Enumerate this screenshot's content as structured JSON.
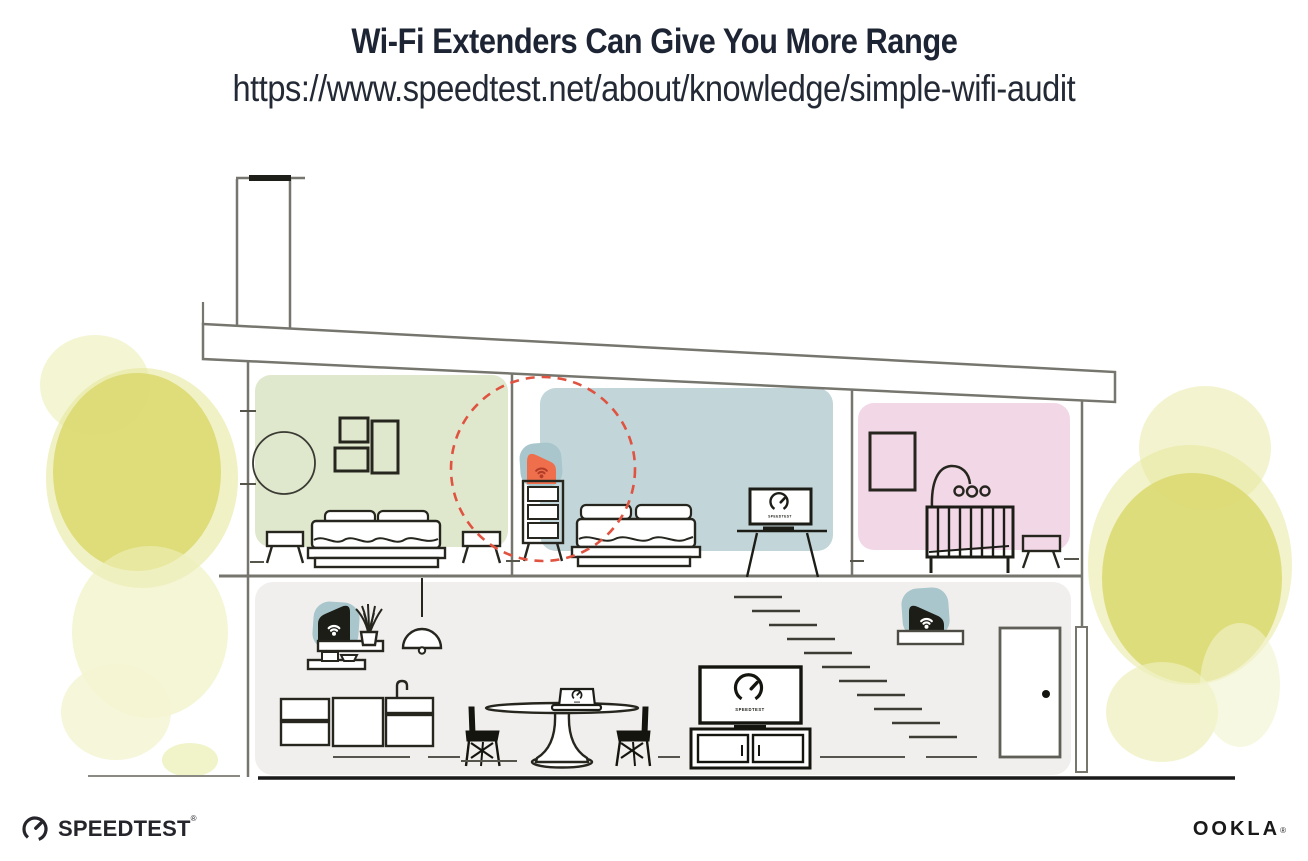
{
  "header": {
    "title": "Wi-Fi Extenders Can Give You More Range",
    "url": "https://www.speedtest.net/about/knowledge/simple-wifi-audit"
  },
  "branding": {
    "speedtest_wordmark": "SPEEDTEST",
    "speedtest_reg_mark": "®",
    "ookla_wordmark": "OOKLA",
    "ookla_reg_mark": "®"
  },
  "illustration": {
    "tv_label": "SPEEDTEST",
    "colors": {
      "room_green": "#dfe8cd",
      "room_blue": "#c2d5d9",
      "room_pink": "#f2d7e7",
      "floor_gray": "#f1efed",
      "extender_teal": "#a9c6cc",
      "extender_orange": "#ef6f4c",
      "wifi_dark_red": "#b23c28",
      "range_red": "#df5340",
      "foliage_yellow": "#dcdb76",
      "foliage_pale": "#eef0bb",
      "line_gray": "#76766e",
      "ink_dark": "#26261f"
    }
  }
}
